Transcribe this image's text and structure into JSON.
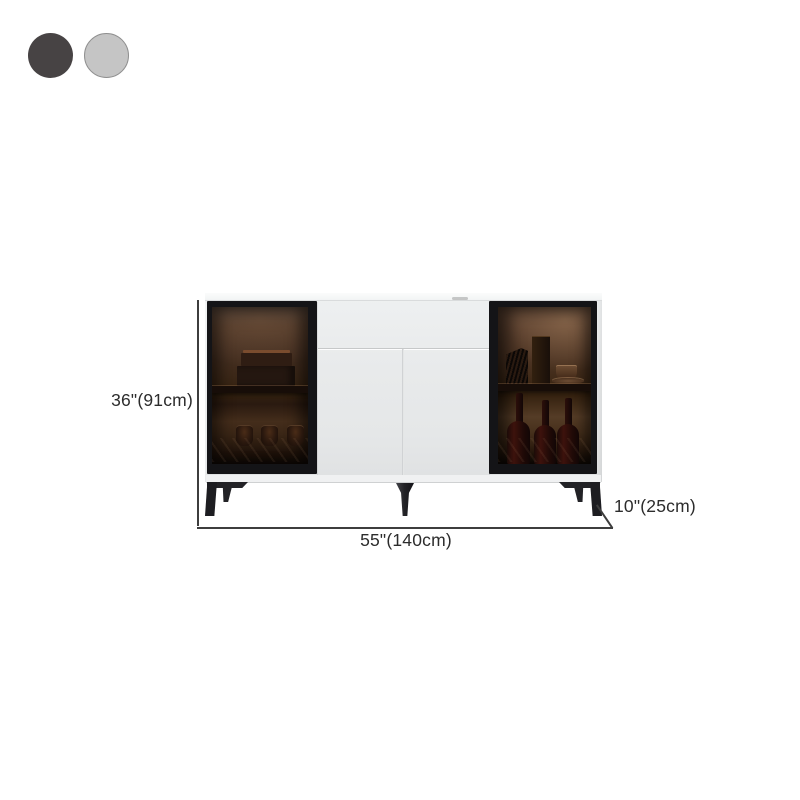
{
  "page": {
    "background_color": "#ffffff"
  },
  "color_swatches": {
    "options": [
      {
        "name": "dark-gray",
        "color": "#474344"
      },
      {
        "name": "light-gray",
        "color": "#c5c5c5",
        "border_color": "#8f8f8f"
      }
    ]
  },
  "product": {
    "name": "sideboard-with-glass-doors",
    "body_color": "#e7e9ea",
    "door_frame_color": "#141417",
    "leg_color": "#222226",
    "interior_glow_color": "#553c26",
    "left_cabinet_contents": [
      "stacked-books",
      "three-glasses"
    ],
    "right_cabinet_contents": [
      "record-stand",
      "tall-vase",
      "cup-and-saucer",
      "three-wine-bottles"
    ]
  },
  "dimensions": {
    "height_label": "36\"(91cm)",
    "width_label": "55\"(140cm)",
    "depth_label": "10\"(25cm)",
    "line_color": "#3d3d3d",
    "text_color": "#2c2c2c"
  }
}
